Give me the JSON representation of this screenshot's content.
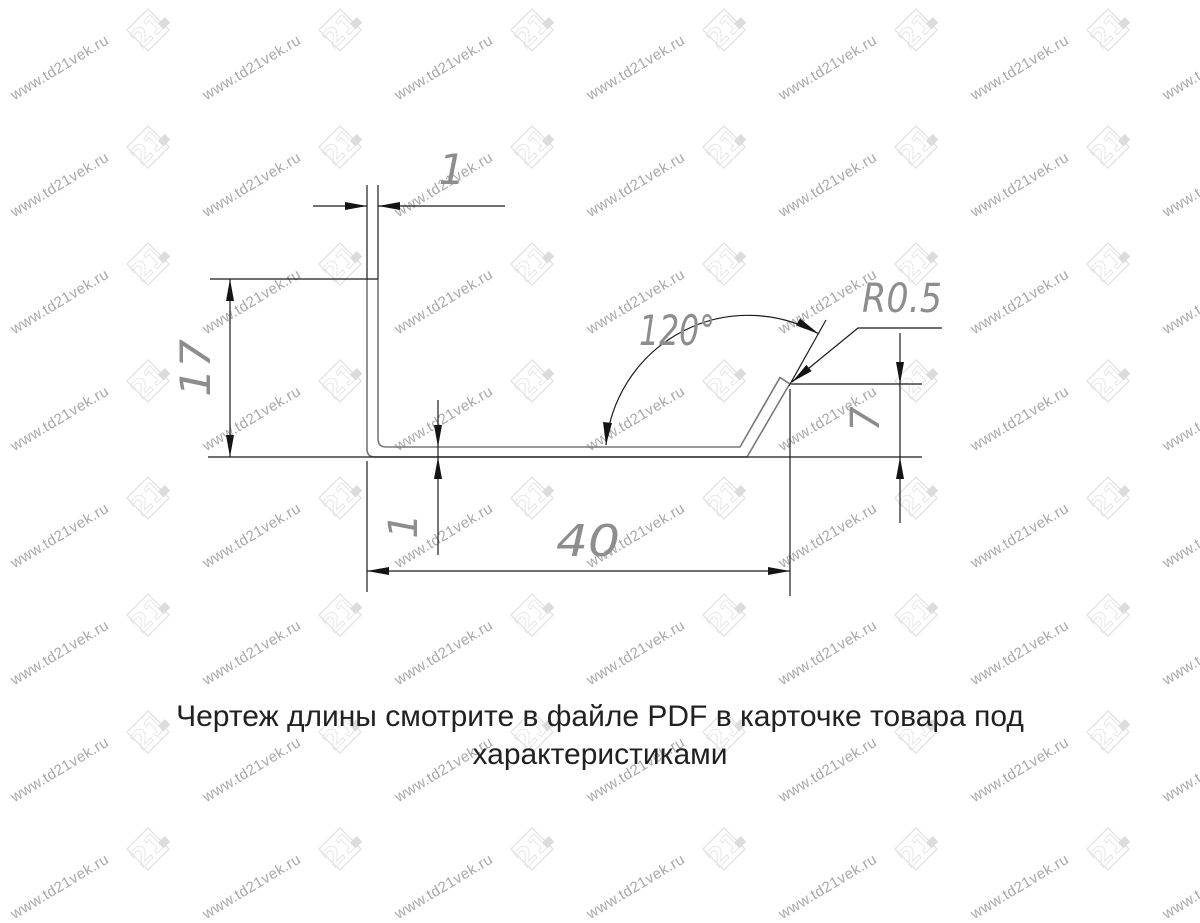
{
  "watermark": {
    "site_text": "www.td21vek.ru",
    "logo_text": "21",
    "text_color": "#a9a9a9",
    "logo_color": "#e4e4e4"
  },
  "drawing": {
    "labels": {
      "top_thickness": "1",
      "height": "17",
      "angle": "120°",
      "radius": "R0.5",
      "flange_height": "7",
      "bottom_thickness": "1",
      "width": "40"
    },
    "colors": {
      "profile_line": "#787878",
      "dimension_line": "#1b1b1b",
      "dimension_text": "#8d8d8d"
    }
  },
  "caption": {
    "text": "Чертеж длины смотрите в файле PDF в карточке товара под характеристиками"
  }
}
